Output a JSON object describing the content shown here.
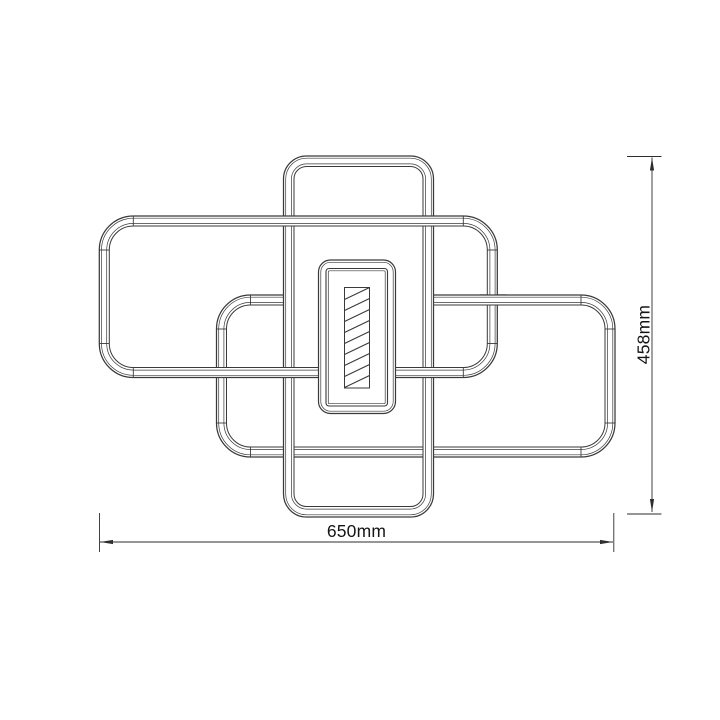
{
  "page": {
    "background": "#ffffff"
  },
  "drawing": {
    "name": "LED ceiling light dimensioned line drawing, top view",
    "line_color": "#3a3a3a",
    "dim_line_color": "#2e2e2e",
    "label_color": "#151515",
    "canvas": {
      "width": 720,
      "height": 720
    },
    "frames": [
      {
        "id": "lower-right-frame",
        "x": 216.5,
        "y": 295,
        "w": 398.5,
        "h": 162,
        "r": 34,
        "tube": 10,
        "ticks": true
      },
      {
        "id": "center-vertical-frame",
        "x": 283.5,
        "y": 156,
        "w": 150,
        "h": 361,
        "r": 23,
        "tube": 10.5,
        "ticks": false
      },
      {
        "id": "upper-left-frame",
        "x": 99.3,
        "y": 216,
        "w": 398,
        "h": 161.5,
        "r": 34,
        "tube": 10,
        "ticks": true
      }
    ],
    "edge_whiteouts": [
      {
        "after_frame": 0,
        "x": 292,
        "y": 292,
        "w": 132,
        "h": 14
      }
    ],
    "overlap_patches": [
      {
        "frame_index": 0,
        "x": 480,
        "y": 289,
        "w": 27,
        "h": 23
      }
    ],
    "center_panel": {
      "outer": {
        "x": 318.5,
        "y": 260,
        "w": 77,
        "h": 153.5,
        "r": 12
      },
      "inner": {
        "x": 326,
        "y": 268.5,
        "w": 61.5,
        "h": 137.5,
        "r": 3
      },
      "hatch_bar": {
        "x": 344.5,
        "y": 287.5,
        "w": 25,
        "h": 100.5,
        "line_count": 9,
        "spacing": 11,
        "rise": 12
      }
    },
    "dimensions": {
      "width": {
        "label": "650mm",
        "line_y": 542,
        "x1": 100,
        "x2": 613,
        "ext_x1": 99.5,
        "ext_x2": 613.8,
        "ext_y1": 513,
        "ext_y2": 552
      },
      "height": {
        "label": "458mm",
        "line_x": 652,
        "y1": 157.5,
        "y2": 512,
        "ext_y1": 156.5,
        "ext_y2": 514,
        "ext_x1": 627,
        "ext_x2": 661.5
      }
    }
  }
}
